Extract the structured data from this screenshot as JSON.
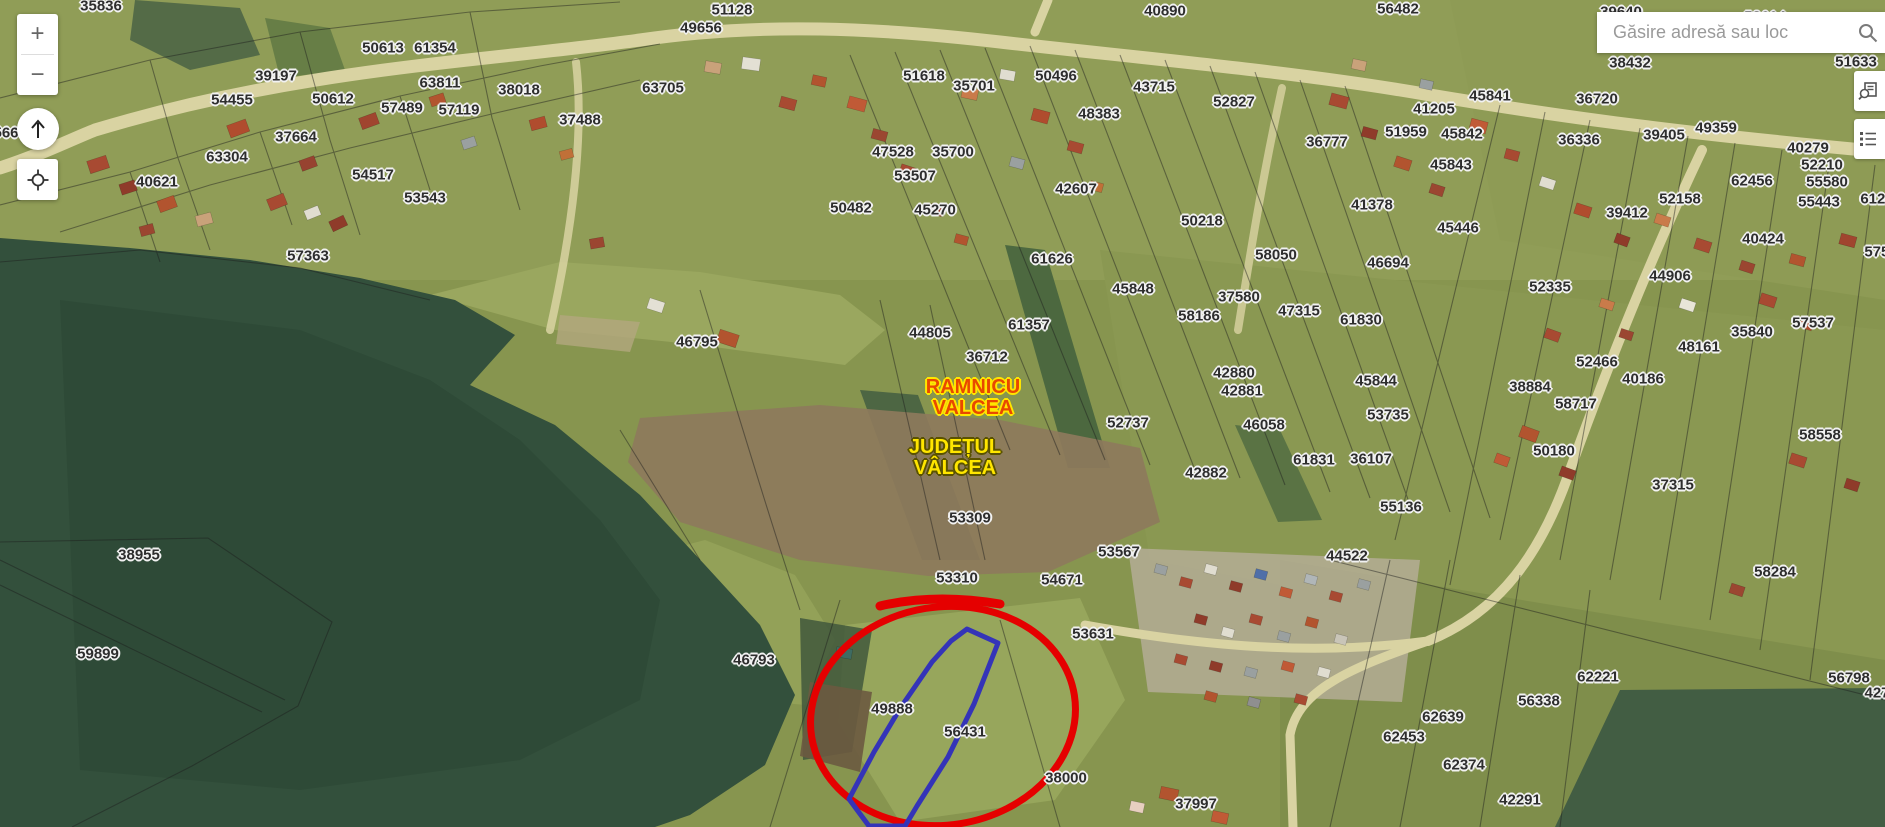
{
  "search": {
    "placeholder": "Găsire adresă sau loc"
  },
  "controls": {
    "zoom_in": "+",
    "zoom_out": "−"
  },
  "map": {
    "city_label": {
      "line1": "RAMNICU",
      "line2": "VALCEA",
      "color": "#e84800",
      "halo": "#ffe600"
    },
    "county_label": {
      "line1": "JUDEȚUL",
      "line2": "VÂLCEA",
      "color": "#ffe600",
      "halo": "#5a5200"
    },
    "annotations": {
      "highlight_ellipse_color": "#e50000",
      "selected_parcel_outline_color": "#3434b8"
    },
    "parcel_labels": [
      {
        "t": "35836",
        "x": 101,
        "y": 6
      },
      {
        "t": "51128",
        "x": 732,
        "y": 10
      },
      {
        "t": "49656",
        "x": 701,
        "y": 28
      },
      {
        "t": "40890",
        "x": 1165,
        "y": 11
      },
      {
        "t": "56482",
        "x": 1398,
        "y": 9
      },
      {
        "t": "39640",
        "x": 1621,
        "y": 12
      },
      {
        "t": "58614",
        "x": 1765,
        "y": 17
      },
      {
        "t": "50613",
        "x": 383,
        "y": 48
      },
      {
        "t": "61354",
        "x": 435,
        "y": 48
      },
      {
        "t": "39197",
        "x": 276,
        "y": 76
      },
      {
        "t": "63811",
        "x": 440,
        "y": 83
      },
      {
        "t": "38018",
        "x": 519,
        "y": 90
      },
      {
        "t": "63705",
        "x": 663,
        "y": 88
      },
      {
        "t": "54455",
        "x": 232,
        "y": 100
      },
      {
        "t": "50612",
        "x": 333,
        "y": 99
      },
      {
        "t": "57489",
        "x": 402,
        "y": 108
      },
      {
        "t": "57119",
        "x": 459,
        "y": 110
      },
      {
        "t": "37488",
        "x": 580,
        "y": 120
      },
      {
        "t": "37664",
        "x": 296,
        "y": 137
      },
      {
        "t": "63304",
        "x": 227,
        "y": 157
      },
      {
        "t": "40621",
        "x": 157,
        "y": 182
      },
      {
        "t": "54517",
        "x": 373,
        "y": 175
      },
      {
        "t": "53543",
        "x": 425,
        "y": 198
      },
      {
        "t": "57363",
        "x": 308,
        "y": 256
      },
      {
        "t": "566",
        "x": 6,
        "y": 133
      },
      {
        "t": "46795",
        "x": 697,
        "y": 342
      },
      {
        "t": "51618",
        "x": 924,
        "y": 76
      },
      {
        "t": "35701",
        "x": 974,
        "y": 86
      },
      {
        "t": "50496",
        "x": 1056,
        "y": 76
      },
      {
        "t": "43715",
        "x": 1154,
        "y": 87
      },
      {
        "t": "48383",
        "x": 1099,
        "y": 114
      },
      {
        "t": "47528",
        "x": 893,
        "y": 152
      },
      {
        "t": "35700",
        "x": 953,
        "y": 152
      },
      {
        "t": "53507",
        "x": 915,
        "y": 176
      },
      {
        "t": "50482",
        "x": 851,
        "y": 208
      },
      {
        "t": "45270",
        "x": 935,
        "y": 210
      },
      {
        "t": "42607",
        "x": 1076,
        "y": 189
      },
      {
        "t": "61626",
        "x": 1052,
        "y": 259
      },
      {
        "t": "50218",
        "x": 1202,
        "y": 221
      },
      {
        "t": "58050",
        "x": 1276,
        "y": 255
      },
      {
        "t": "46694",
        "x": 1388,
        "y": 263
      },
      {
        "t": "52827",
        "x": 1234,
        "y": 102
      },
      {
        "t": "45841",
        "x": 1490,
        "y": 96
      },
      {
        "t": "41205",
        "x": 1434,
        "y": 109
      },
      {
        "t": "36720",
        "x": 1597,
        "y": 99
      },
      {
        "t": "51959",
        "x": 1406,
        "y": 132
      },
      {
        "t": "45842",
        "x": 1462,
        "y": 134
      },
      {
        "t": "36777",
        "x": 1327,
        "y": 142
      },
      {
        "t": "36336",
        "x": 1579,
        "y": 140
      },
      {
        "t": "39405",
        "x": 1664,
        "y": 135
      },
      {
        "t": "49359",
        "x": 1716,
        "y": 128
      },
      {
        "t": "38432",
        "x": 1630,
        "y": 63
      },
      {
        "t": "51633",
        "x": 1856,
        "y": 62
      },
      {
        "t": "40279",
        "x": 1808,
        "y": 148
      },
      {
        "t": "52210",
        "x": 1822,
        "y": 165
      },
      {
        "t": "55580",
        "x": 1827,
        "y": 182
      },
      {
        "t": "62456",
        "x": 1752,
        "y": 181
      },
      {
        "t": "55443",
        "x": 1819,
        "y": 202
      },
      {
        "t": "6120",
        "x": 1877,
        "y": 199
      },
      {
        "t": "52158",
        "x": 1680,
        "y": 199
      },
      {
        "t": "39412",
        "x": 1627,
        "y": 213
      },
      {
        "t": "45843",
        "x": 1451,
        "y": 165
      },
      {
        "t": "41378",
        "x": 1372,
        "y": 205
      },
      {
        "t": "45446",
        "x": 1458,
        "y": 228
      },
      {
        "t": "40424",
        "x": 1763,
        "y": 239
      },
      {
        "t": "5753",
        "x": 1881,
        "y": 252
      },
      {
        "t": "52335",
        "x": 1550,
        "y": 287
      },
      {
        "t": "44906",
        "x": 1670,
        "y": 276
      },
      {
        "t": "57537",
        "x": 1813,
        "y": 323
      },
      {
        "t": "35840",
        "x": 1752,
        "y": 332
      },
      {
        "t": "48161",
        "x": 1699,
        "y": 347
      },
      {
        "t": "52466",
        "x": 1597,
        "y": 362
      },
      {
        "t": "40186",
        "x": 1643,
        "y": 379
      },
      {
        "t": "38884",
        "x": 1530,
        "y": 387
      },
      {
        "t": "58717",
        "x": 1576,
        "y": 404
      },
      {
        "t": "58558",
        "x": 1820,
        "y": 435
      },
      {
        "t": "50180",
        "x": 1554,
        "y": 451
      },
      {
        "t": "37315",
        "x": 1673,
        "y": 485
      },
      {
        "t": "58284",
        "x": 1775,
        "y": 572
      },
      {
        "t": "45848",
        "x": 1133,
        "y": 289
      },
      {
        "t": "37580",
        "x": 1239,
        "y": 297
      },
      {
        "t": "58186",
        "x": 1199,
        "y": 316
      },
      {
        "t": "47315",
        "x": 1299,
        "y": 311
      },
      {
        "t": "61830",
        "x": 1361,
        "y": 320
      },
      {
        "t": "61357",
        "x": 1029,
        "y": 325
      },
      {
        "t": "36712",
        "x": 987,
        "y": 357
      },
      {
        "t": "44805",
        "x": 930,
        "y": 333
      },
      {
        "t": "42880",
        "x": 1234,
        "y": 373
      },
      {
        "t": "42881",
        "x": 1242,
        "y": 391
      },
      {
        "t": "45844",
        "x": 1376,
        "y": 381
      },
      {
        "t": "53735",
        "x": 1388,
        "y": 415
      },
      {
        "t": "52737",
        "x": 1128,
        "y": 423
      },
      {
        "t": "46058",
        "x": 1264,
        "y": 425
      },
      {
        "t": "61831",
        "x": 1314,
        "y": 460
      },
      {
        "t": "36107",
        "x": 1371,
        "y": 459
      },
      {
        "t": "42882",
        "x": 1206,
        "y": 473
      },
      {
        "t": "38955",
        "x": 139,
        "y": 555
      },
      {
        "t": "59899",
        "x": 98,
        "y": 654
      },
      {
        "t": "53309",
        "x": 970,
        "y": 518
      },
      {
        "t": "53310",
        "x": 957,
        "y": 578
      },
      {
        "t": "53567",
        "x": 1119,
        "y": 552
      },
      {
        "t": "54671",
        "x": 1062,
        "y": 580
      },
      {
        "t": "44522",
        "x": 1347,
        "y": 556
      },
      {
        "t": "55136",
        "x": 1401,
        "y": 507
      },
      {
        "t": "53631",
        "x": 1093,
        "y": 634
      },
      {
        "t": "46793",
        "x": 754,
        "y": 660
      },
      {
        "t": "49888",
        "x": 892,
        "y": 709
      },
      {
        "t": "56431",
        "x": 965,
        "y": 732
      },
      {
        "t": "38000",
        "x": 1066,
        "y": 778
      },
      {
        "t": "37997",
        "x": 1196,
        "y": 804
      },
      {
        "t": "62221",
        "x": 1598,
        "y": 677
      },
      {
        "t": "56338",
        "x": 1539,
        "y": 701
      },
      {
        "t": "62639",
        "x": 1443,
        "y": 717
      },
      {
        "t": "62453",
        "x": 1404,
        "y": 737
      },
      {
        "t": "62374",
        "x": 1464,
        "y": 765
      },
      {
        "t": "42291",
        "x": 1520,
        "y": 800
      },
      {
        "t": "56798",
        "x": 1849,
        "y": 678
      },
      {
        "t": "427",
        "x": 1877,
        "y": 693
      }
    ]
  }
}
